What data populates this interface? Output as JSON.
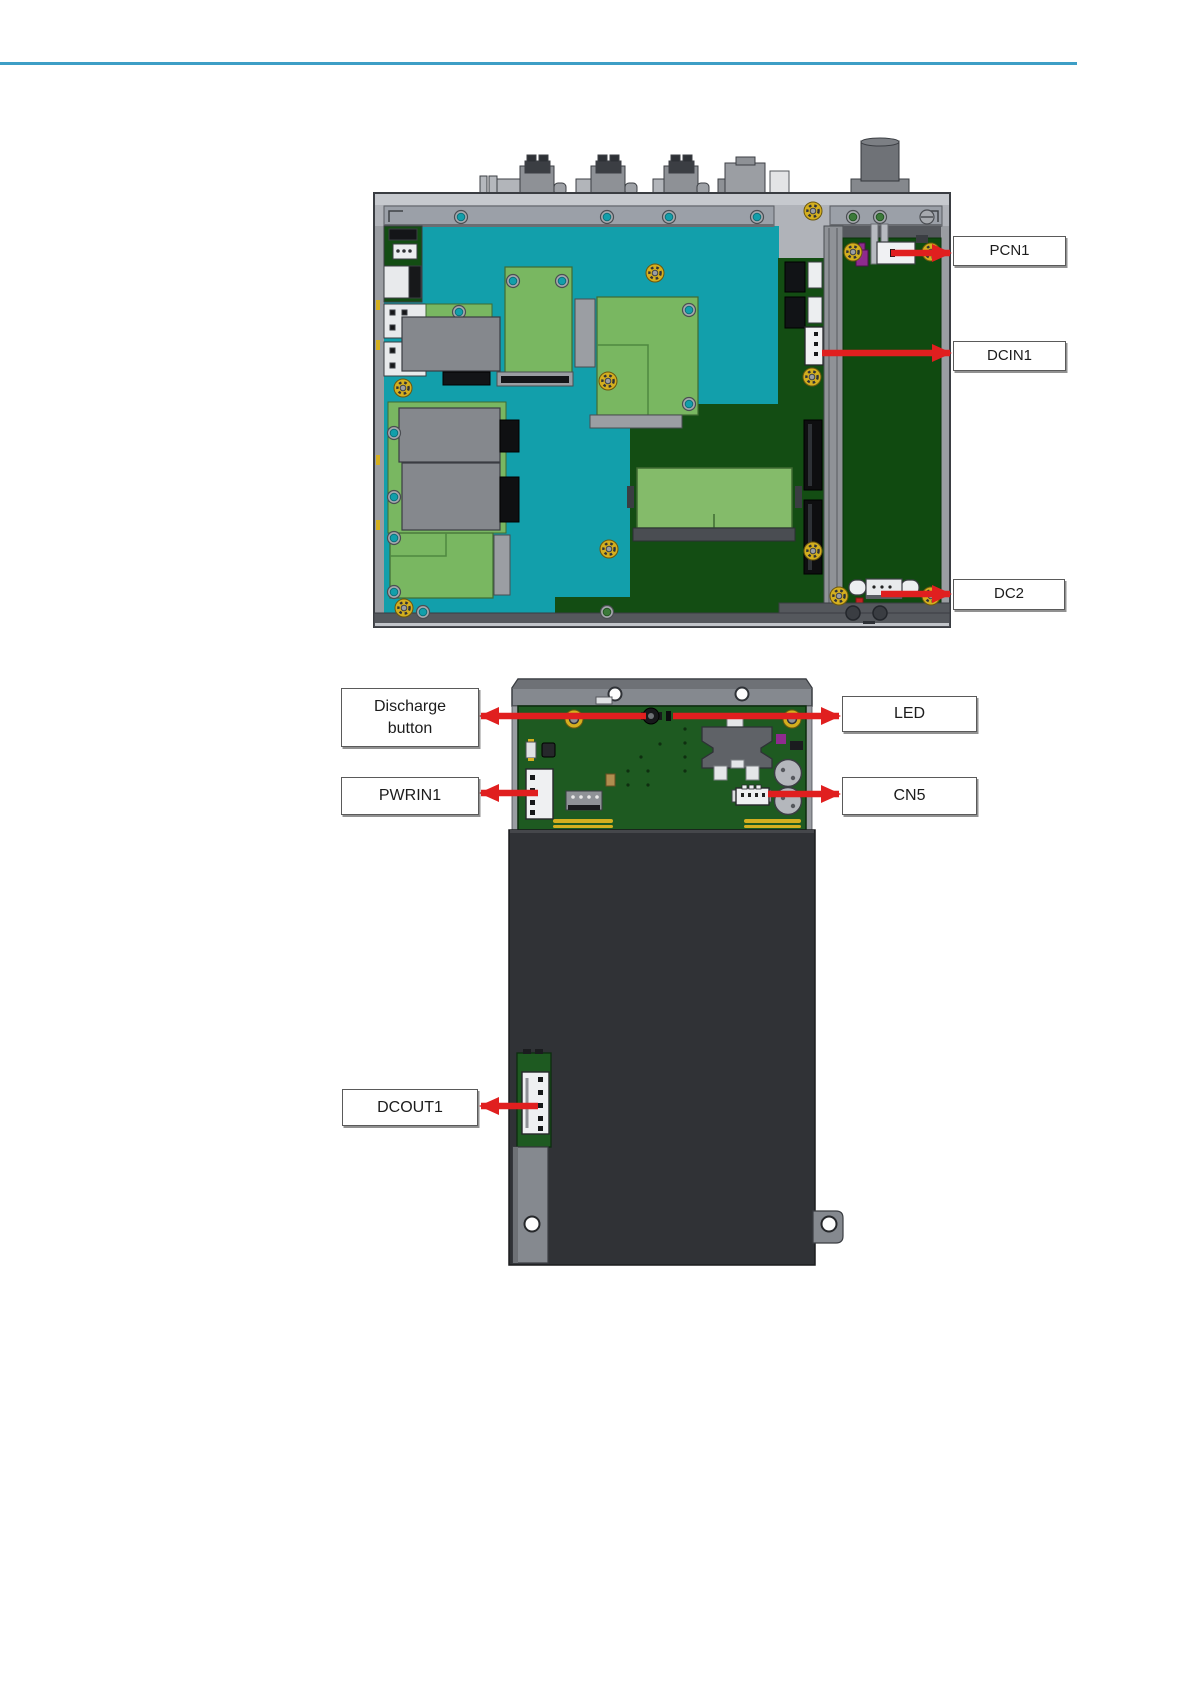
{
  "figure_top": {
    "callouts": [
      {
        "id": "pcn1",
        "label": "PCN1"
      },
      {
        "id": "dcin1",
        "label": "DCIN1"
      },
      {
        "id": "dc2",
        "label": "DC2"
      }
    ]
  },
  "figure_bottom": {
    "callouts": [
      {
        "id": "discharge",
        "label": "Discharge button"
      },
      {
        "id": "led",
        "label": "LED"
      },
      {
        "id": "pwrin1",
        "label": "PWRIN1"
      },
      {
        "id": "cn5",
        "label": "CN5"
      },
      {
        "id": "dcout1",
        "label": "DCOUT1"
      }
    ]
  },
  "colors": {
    "rule_teal": "#3d9ec6",
    "arrow_red": "#e01f1f",
    "teal_board": "#129fab",
    "light_green": "#79b761",
    "mid_green": "#84bb6a",
    "dark_green": "#134d13",
    "battery_pcb_green": "#1e5a21",
    "chassis_gray": "#b0b3b9",
    "panel_gray": "#85898f",
    "battery_dark": "#303236",
    "gold": "#d4af1f",
    "callout_border": "#5a5a5a",
    "text_color": "#1c1c1c"
  }
}
